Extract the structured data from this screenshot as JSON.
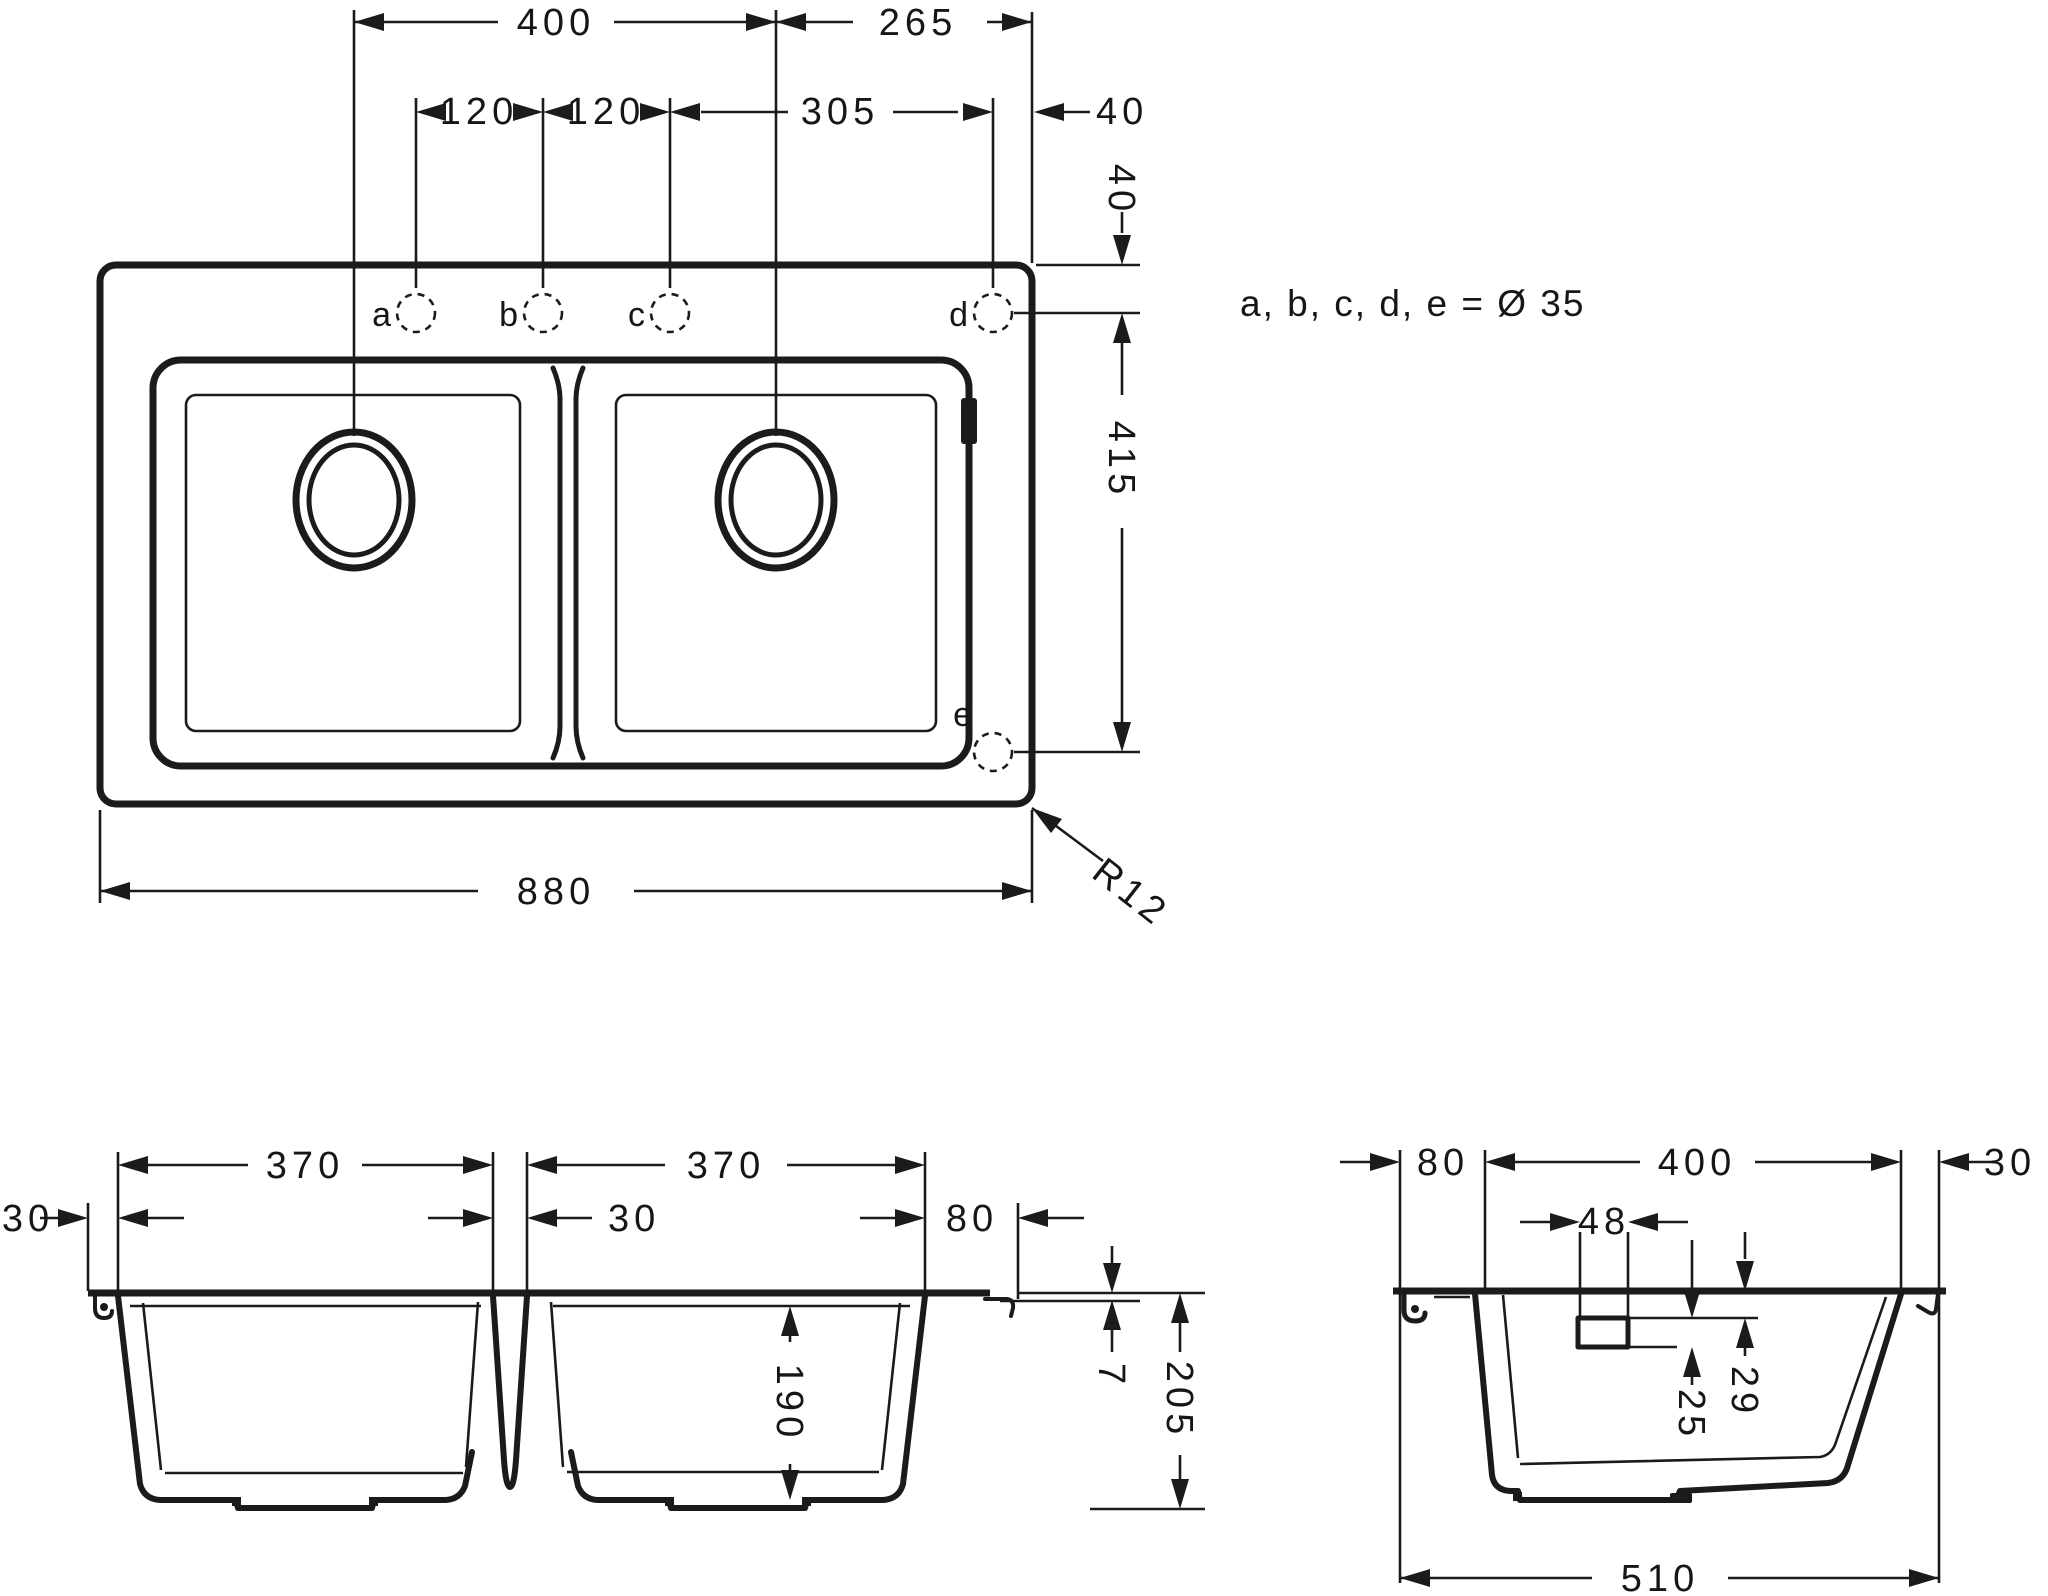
{
  "note": "a, b, c, d, e = Ø 35",
  "plan_view": {
    "dim_drain_to_drain": "400",
    "dim_drain_to_edge": "265",
    "dim_a_to_b": "120",
    "dim_b_to_c": "120",
    "dim_c_to_d": "305",
    "dim_d_to_edge": "40",
    "dim_edge_to_holes": "40",
    "dim_d_to_e": "415",
    "dim_overall_width": "880",
    "corner_radius": "R12",
    "holes": {
      "a": "a",
      "b": "b",
      "c": "c",
      "d": "d",
      "e": "e"
    }
  },
  "front_section": {
    "dim_bowl_left_width": "370",
    "dim_bowl_right_width": "370",
    "dim_rim_left": "30",
    "dim_divider": "30",
    "dim_rim_right": "80",
    "dim_rim_height": "7",
    "dim_bowl_depth": "190",
    "dim_overall_height": "205"
  },
  "side_section": {
    "dim_rim_back": "80",
    "dim_bowl_width": "400",
    "dim_rim_front": "30",
    "dim_overflow_width": "48",
    "dim_overflow_height": "25",
    "dim_overflow_offset": "29",
    "dim_overall_depth": "510"
  }
}
